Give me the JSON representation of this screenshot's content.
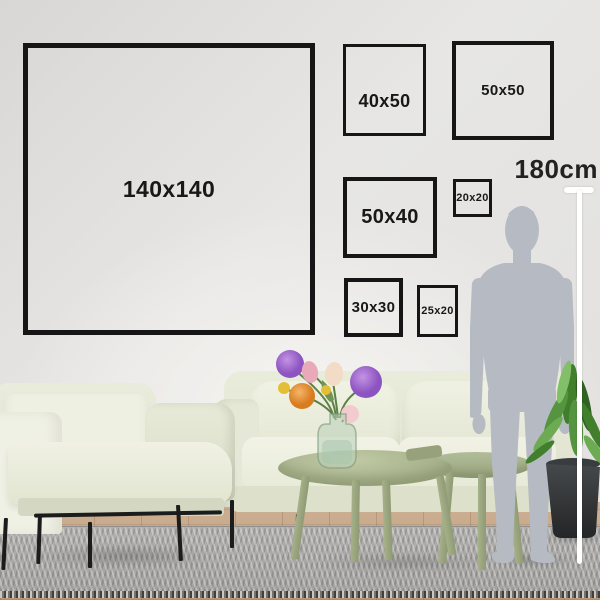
{
  "frames": [
    {
      "label": "140x140",
      "width_cm": 140,
      "height_cm": 140
    },
    {
      "label": "40x50",
      "width_cm": 40,
      "height_cm": 50
    },
    {
      "label": "50x50",
      "width_cm": 50,
      "height_cm": 50
    },
    {
      "label": "50x40",
      "width_cm": 50,
      "height_cm": 40
    },
    {
      "label": "20x20",
      "width_cm": 20,
      "height_cm": 20
    },
    {
      "label": "30x30",
      "width_cm": 30,
      "height_cm": 30
    },
    {
      "label": "25x20",
      "width_cm": 25,
      "height_cm": 20
    }
  ],
  "reference": {
    "label": "180cm",
    "height_cm": 180
  },
  "colors": {
    "frame_border": "#161616",
    "label_text": "#181818",
    "measure_line": "#ffffff",
    "silhouette": "#b6bac2",
    "wall": "#e5e4e2",
    "sofa": "#e9ecdb",
    "table": "#a2ad87",
    "rug": "#a9a8a6",
    "floor_wood": "#c4a283",
    "plant_pot": "#303335",
    "flower_purple": "#9a63c9",
    "flower_orange": "#e2913c",
    "flower_pink": "#e8a9b8",
    "flower_yellow": "#e3bf37"
  }
}
